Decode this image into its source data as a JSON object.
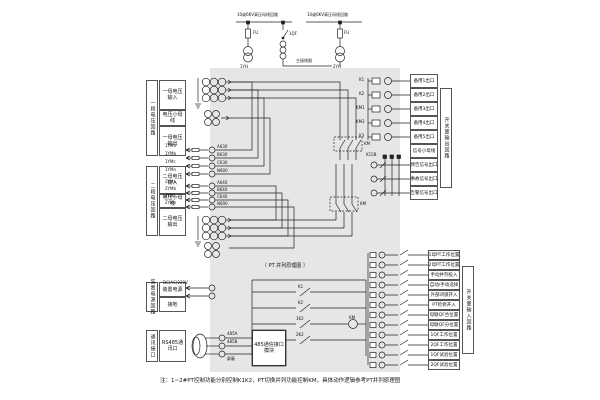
{
  "page": {
    "note": "注：1~2#PT控制功能分别控制K1K2，PT切换并列功能控制KM，具体动作逻辑参考PT并列原理图"
  },
  "top": {
    "bus1": "10或6KV高压母线回路",
    "bus2": "10或6KV高压母线回路",
    "fu1": "FU",
    "fu2": "FU",
    "qf1": "1QF",
    "pt1": "1YH",
    "pt2": "2YH",
    "main": "主接线图"
  },
  "left": {
    "g1_side": "一段电压回路",
    "g1_cells": [
      "一母电压输入",
      "电压小母线",
      "一母电压输出"
    ],
    "g2_side": "二段电压回路",
    "g2_cells": [
      "二母电压输入",
      "电压小母线",
      "二母电压输出"
    ],
    "pw_side": "装置电源回路",
    "pw_cells": [
      "装置电源",
      "接地"
    ],
    "cm_side": "通讯接口",
    "cm_cell": "RS485通讯口"
  },
  "mid": {
    "w1": [
      "1YMa",
      "1YMb",
      "1YMc",
      "1YMn"
    ],
    "t1": [
      "A630",
      "B630",
      "C630",
      "N600"
    ],
    "w2": [
      "2YMa",
      "2YMb",
      "2YMc",
      "2YMn"
    ],
    "t2": [
      "A640",
      "B640",
      "C640",
      "N600"
    ],
    "km1": "KM",
    "km2": "KM",
    "parallel_title": "〔 PT 并列原理图 〕",
    "power_wire": "DC(AC)220V",
    "rs485_box": "485通信接口模块",
    "rs485_wires": [
      "485A",
      "485B",
      "屏蔽"
    ],
    "contacts": {
      "c1": "K1",
      "c2": "K2",
      "c3": "1K2",
      "c4": "2K2",
      "coil": "KM"
    }
  },
  "right": {
    "out_side": "开关量输出回路",
    "out_rows": [
      "备用1出口",
      "备用2出口",
      "备用3出口",
      "备用4出口",
      "备用5出口",
      "信号小母线",
      "预告信号出口",
      "事故信号出口",
      "告警信号出口"
    ],
    "out_coils": [
      "K1",
      "K2",
      "KM1",
      "KM2",
      "K3"
    ],
    "k15": "K15B",
    "in_side": "开关量输入回路",
    "in_rows": [
      "1母PT工作位置",
      "2母PT工作位置",
      "手动并列投入",
      "自动/手动选择",
      "外部闭锁开入",
      "PT检修开入",
      "母联QF合位置",
      "母联QF分位置",
      "1QF工作位置",
      "2QF工作位置",
      "1QF试验位置",
      "2QF试验位置"
    ]
  }
}
